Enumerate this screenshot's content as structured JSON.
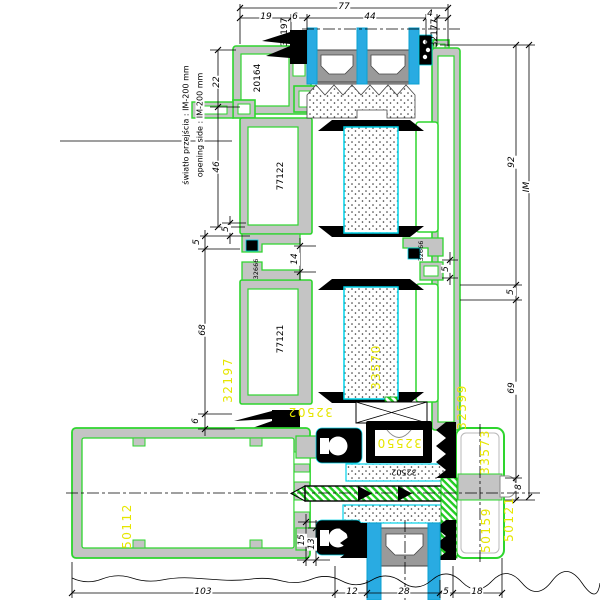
{
  "colors": {
    "profile_green": "#2ed52e",
    "wall_gray": "#c4c4c4",
    "glass_blue": "#29abe2",
    "highlight_cyan": "#00d2e8",
    "gasket_black": "#000000",
    "label_yellow": "#e6e600"
  },
  "notes": {
    "pl": "światło przejścia : IM-200 mm",
    "en": "opening side : IM-200 mm"
  },
  "dims": {
    "d77": "77",
    "d19": "19",
    "d6a": "6",
    "d44": "44",
    "d4": "4",
    "d22": "22",
    "d46": "46",
    "d5a": "5",
    "d5b": "5",
    "d68": "68",
    "d6b": "6",
    "d14": "14",
    "d92": "92",
    "d5c": "5",
    "d5d": "5",
    "d69": "69",
    "d8": "8",
    "dim": "IM",
    "d15": "15",
    "d13": "13",
    "d103": "103",
    "d12": "12",
    "d28": "28",
    "d5e": "5",
    "d18": "18"
  },
  "parts": {
    "clamp_top": "32197",
    "clamp_top_right": "32177",
    "frame_head": "20164",
    "sash_upper": "77122",
    "sash_lower": "77121",
    "gasket_small_left": "32666",
    "gasket_small_right": "32666",
    "profile_left_yellow": "32197",
    "profile_right_yellow": "32599",
    "gasket_bottom_yellow": "32502",
    "infill_panel": "33570",
    "glazing_block": "32550",
    "clamp_strip": "32502",
    "threshold": "50112",
    "cover_side": "33573",
    "cover_bottom": "50159",
    "cover_cap": "50121"
  }
}
